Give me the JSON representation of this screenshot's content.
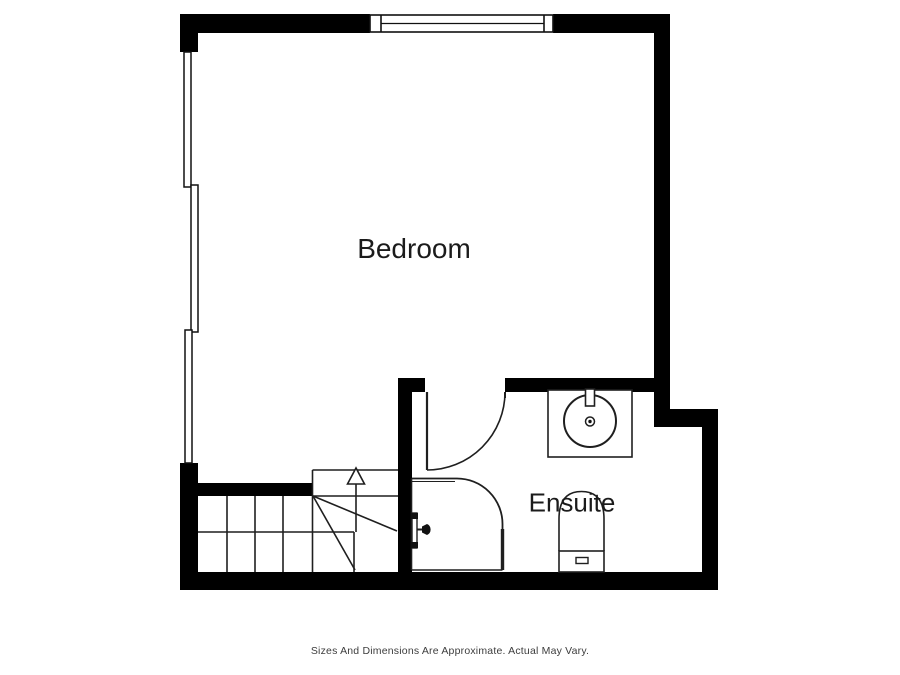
{
  "meta": {
    "type": "floorplan",
    "background_color": "#ffffff",
    "wall_color": "#000000",
    "line_color": "#1f1f1f",
    "label_color": "#1b1b1b",
    "disclaimer_color": "#3d3d3d"
  },
  "rooms": {
    "bedroom": {
      "label": "Bedroom"
    },
    "ensuite": {
      "label": "Ensuite"
    }
  },
  "fixtures": [
    {
      "name": "top-window-icon"
    },
    {
      "name": "left-window-icon"
    },
    {
      "name": "ensuite-door-icon"
    },
    {
      "name": "shower-enclosure-icon"
    },
    {
      "name": "shower-valve-icon"
    },
    {
      "name": "sink-icon"
    },
    {
      "name": "toilet-icon"
    },
    {
      "name": "staircase-icon"
    },
    {
      "name": "stairs-up-arrow-icon"
    }
  ],
  "footer": {
    "disclaimer": "Sizes And Dimensions Are Approximate. Actual May Vary."
  }
}
